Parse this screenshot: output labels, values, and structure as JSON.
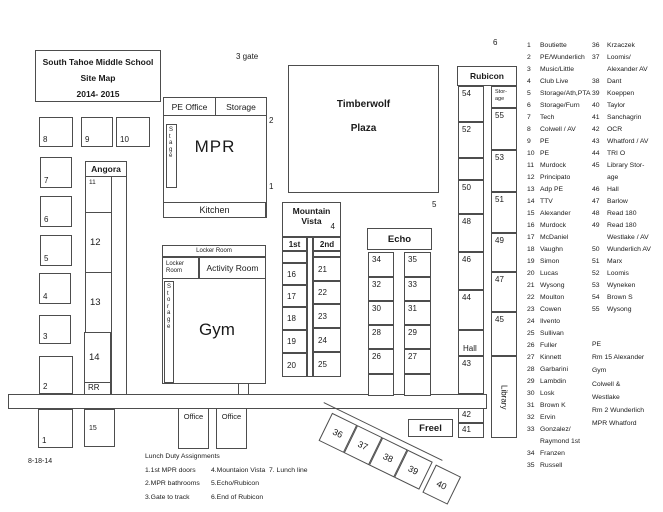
{
  "title": {
    "line1": "South Tahoe Middle School",
    "line2": "Site Map",
    "line3": "2014- 2015"
  },
  "annotations": {
    "gate3": "3 gate",
    "n6": "6",
    "n5": "5",
    "n4": "4",
    "n2": "2",
    "n1": "1",
    "n7": "7",
    "date": "8-18-14"
  },
  "left_rooms": {
    "r8": "8",
    "r9": "9",
    "r10": "10",
    "r7": "7",
    "r6": "6",
    "r5": "5",
    "r4": "4",
    "r3": "3",
    "r2": "2",
    "r1": "1",
    "r15": "15"
  },
  "angora": {
    "name": "Angora",
    "r11": "11",
    "r12": "12",
    "r13": "13",
    "r14": "14",
    "rr": "RR"
  },
  "mpr": {
    "pe_office": "PE Office",
    "storage": "Storage",
    "stage": "S\nt\na\ng\ne",
    "name": "MPR",
    "kitchen": "Kitchen"
  },
  "timberwolf": {
    "line1": "Timberwolf",
    "line2": "Plaza"
  },
  "gym": {
    "locker_top": "Locker Room",
    "locker_left": "Locker\nRoom",
    "activity": "Activity Room",
    "storage": "S\nt\no\nr\na\ng\ne",
    "name": "Gym"
  },
  "mountain_vista": {
    "line1": "Mountain",
    "line2": "Vista",
    "col1": "1st",
    "col2": "2nd",
    "first": [
      "16",
      "17",
      "18",
      "19",
      "20"
    ],
    "second": [
      "21",
      "22",
      "23",
      "24",
      "25"
    ]
  },
  "echo": {
    "name": "Echo",
    "left": [
      "34",
      "32",
      "30",
      "28",
      "26"
    ],
    "right": [
      "35",
      "33",
      "31",
      "29",
      "27"
    ]
  },
  "rubicon": {
    "name": "Rubicon",
    "left": [
      "54",
      "52",
      "",
      "50",
      "48",
      "46",
      "44"
    ],
    "hall": "Hall",
    "r43": "43",
    "r42": "42",
    "r41": "41",
    "storage": "Stor-\nage",
    "right": [
      "55",
      "53",
      "51",
      "49",
      "47",
      "45"
    ],
    "library": "Library"
  },
  "freel": {
    "name": "Freel",
    "rooms": [
      "36",
      "37",
      "38",
      "39",
      "40"
    ]
  },
  "offices": {
    "o1": "Office",
    "o2": "Office"
  },
  "legend": {
    "col1": [
      {
        "n": "1",
        "name": "Boutiette"
      },
      {
        "n": "2",
        "name": "PE/Wunderlich"
      },
      {
        "n": "3",
        "name": "Music/Little"
      },
      {
        "n": "4",
        "name": "Club Live"
      },
      {
        "n": "5",
        "name": "Storage/Ath,PTA"
      },
      {
        "n": "6",
        "name": "Storage/Furn"
      },
      {
        "n": "7",
        "name": "Tech"
      },
      {
        "n": "8",
        "name": "Colwell / AV"
      },
      {
        "n": "9",
        "name": "PE"
      },
      {
        "n": "10",
        "name": "PE"
      },
      {
        "n": "11",
        "name": "Murdock"
      },
      {
        "n": "12",
        "name": "Principato"
      },
      {
        "n": "13",
        "name": "Adp PE"
      },
      {
        "n": "14",
        "name": "TTV"
      },
      {
        "n": "15",
        "name": "Alexander"
      },
      {
        "n": "16",
        "name": "Murdock"
      },
      {
        "n": "17",
        "name": "McDaniel"
      },
      {
        "n": "18",
        "name": "Vaughn"
      },
      {
        "n": "19",
        "name": "Simon"
      },
      {
        "n": "20",
        "name": "Lucas"
      },
      {
        "n": "21",
        "name": "Wysong"
      },
      {
        "n": "22",
        "name": "Moulton"
      },
      {
        "n": "23",
        "name": "Cowen"
      },
      {
        "n": "24",
        "name": "Ilvento"
      },
      {
        "n": "25",
        "name": "Sullivan"
      },
      {
        "n": "26",
        "name": "Fuller"
      },
      {
        "n": "27",
        "name": "Kinnett"
      },
      {
        "n": "28",
        "name": "Garbarini"
      },
      {
        "n": "29",
        "name": "Lambdin"
      },
      {
        "n": "30",
        "name": "Losk"
      },
      {
        "n": "31",
        "name": "Brown K"
      },
      {
        "n": "32",
        "name": "Ervin"
      },
      {
        "n": "33",
        "name": "Gonzalez/\nRaymond 1st"
      },
      {
        "n": "34",
        "name": "Franzen"
      },
      {
        "n": "35",
        "name": "Russell"
      }
    ],
    "col2": [
      {
        "n": "36",
        "name": "Krzaczek"
      },
      {
        "n": "37",
        "name": "Loomis/\nAlexander AV"
      },
      {
        "n": "38",
        "name": "Dant"
      },
      {
        "n": "39",
        "name": "Koeppen"
      },
      {
        "n": "40",
        "name": "Taylor"
      },
      {
        "n": "41",
        "name": "Sanchagrin"
      },
      {
        "n": "42",
        "name": "OCR"
      },
      {
        "n": "43",
        "name": "Whatford / AV"
      },
      {
        "n": "44",
        "name": "TRI O"
      },
      {
        "n": "45",
        "name": "Library Stor-\nage"
      },
      {
        "n": "46",
        "name": "Hall"
      },
      {
        "n": "47",
        "name": "Barlow"
      },
      {
        "n": "48",
        "name": "Read 180"
      },
      {
        "n": "49",
        "name": "Read 180\nWestlake / AV"
      },
      {
        "n": "50",
        "name": "Wunderlich  AV"
      },
      {
        "n": "51",
        "name": "Marx"
      },
      {
        "n": "52",
        "name": "Loomis"
      },
      {
        "n": "53",
        "name": "Wyneken"
      },
      {
        "n": "54",
        "name": "Brown S"
      },
      {
        "n": "55",
        "name": "Wysong"
      }
    ],
    "extra": "PE\nRm 15  Alexander\nGym\nColwell &\nWestlake\nRm 2 Wunderlich\nMPR  Whatford"
  },
  "lunch": {
    "title": "Lunch Duty Assignments",
    "rows": [
      [
        "1.1st MPR doors",
        "4.Mountaion Vista",
        "7. Lunch line"
      ],
      [
        "2.MPR bathrooms",
        "5.Echo/Rubicon",
        ""
      ],
      [
        "3.Gate to track",
        "6.End of Rubicon",
        ""
      ]
    ]
  }
}
